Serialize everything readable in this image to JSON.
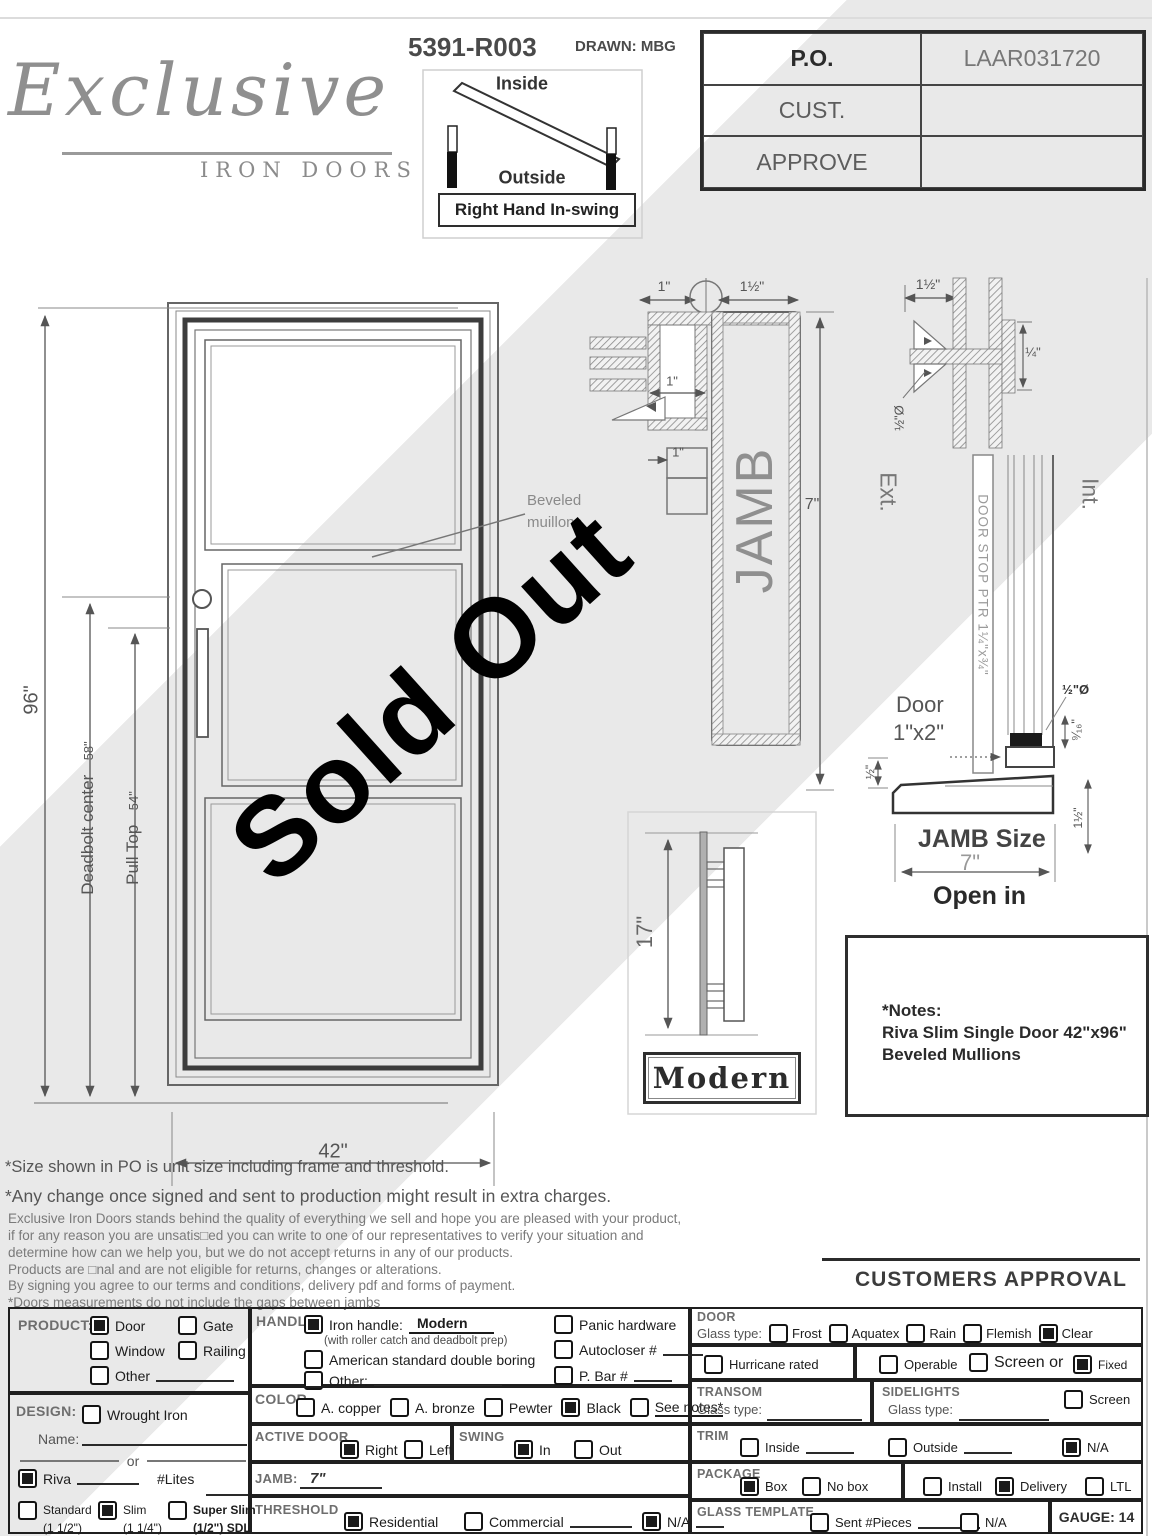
{
  "header": {
    "logo_script": "Exclusive",
    "logo_subtitle": "IRON DOORS",
    "drawing_number": "5391-R003",
    "drawn_by": "DRAWN: MBG"
  },
  "swing_diagram": {
    "inside_label": "Inside",
    "outside_label": "Outside",
    "caption": "Right Hand In-swing"
  },
  "po_table": {
    "rows": [
      {
        "label": "P.O.",
        "value": "LAAR031720"
      },
      {
        "label": "CUST.",
        "value": ""
      },
      {
        "label": "APPROVE",
        "value": ""
      }
    ]
  },
  "elevation": {
    "height_dim": "96\"",
    "deadbolt_label": "Deadbolt center",
    "deadbolt_dim": "58\"",
    "pull_label": "Pull Top",
    "pull_dim": "54\"",
    "width_dim": "42\"",
    "mullion_note_line1": "Beveled",
    "mullion_note_line2": "muillons"
  },
  "jamb_detail": {
    "dim_top_left": "1\"",
    "dim_top_right": "1½\"",
    "dim_mid": "1\"",
    "dim_lower": "1\"",
    "jamb_label": "JAMB",
    "height_dim": "7\""
  },
  "section_detail": {
    "dim_top": "1½\"",
    "dim_quarter": "¼\"",
    "dim_half_dia": "½\"Ø",
    "ext_label": "Ext.",
    "int_label": "Int.",
    "door_stop_label": "DOOR STOP PTR 1¼\"x¾\"",
    "door_label_line1": "Door",
    "door_label_line2": "1\"x2\"",
    "dim_half_dia_2": "½\"Ø",
    "dim_nine_sixteenths": "⁹⁄₁₆\"",
    "dim_half": "½\"",
    "dim_one_and_half": "1½\"",
    "jamb_size_label": "JAMB Size",
    "jamb_size_value": "7\"",
    "open_label": "Open in"
  },
  "handle_detail": {
    "height_dim": "17\"",
    "style_label": "Modern"
  },
  "notes": {
    "title": "*Notes:",
    "line1": "Riva Slim Single Door 42\"x96\"",
    "line2": "Beveled Mullions"
  },
  "watermark": {
    "text": "Sold Out"
  },
  "disclaimers": {
    "line1": "*Size shown in PO is unit size including frame and threshold.",
    "line2": "*Any change once signed and sent to production might result in extra charges.",
    "line3": "Exclusive Iron Doors stands behind the quality of everything we sell and hope you are pleased with your product,",
    "line4": "if for any reason you are unsatis□ed you can write to one of our representatives to verify your situation and",
    "line5": "determine how can we help you, but we do not accept returns in any of our products.",
    "line6": "Products are □nal and are not eligible for returns, changes or alterations.",
    "line7": "By signing you agree to our terms and conditions, delivery pdf and forms of payment.",
    "line8": "*Doors measurements do not include the gaps between jambs"
  },
  "approval": {
    "title": "CUSTOMERS APPROVAL"
  },
  "form": {
    "product": {
      "label": "PRODUCT:",
      "door": {
        "label": "Door",
        "checked": true
      },
      "gate": {
        "label": "Gate",
        "checked": false
      },
      "window": {
        "label": "Window",
        "checked": false
      },
      "railing": {
        "label": "Railing",
        "checked": false
      },
      "other": {
        "label": "Other",
        "checked": false
      }
    },
    "design": {
      "label": "DESIGN:",
      "wrought_iron": {
        "label": "Wrought Iron",
        "checked": false
      },
      "name_label": "Name:",
      "or_label": "or",
      "riva": {
        "label": "Riva",
        "checked": true
      },
      "lites_label": "#Lites",
      "standard": {
        "label": "Standard",
        "sub": "(1 1/2\")",
        "checked": false
      },
      "slim": {
        "label": "Slim",
        "sub": "(1 1/4\")",
        "checked": true
      },
      "super_slim": {
        "label": "Super Slim",
        "sub": "(1/2\") SDL",
        "checked": false
      }
    },
    "handle": {
      "label": "HANDLE",
      "iron_handle": {
        "label": "Iron handle:",
        "value": "Modern",
        "note": "(with roller catch and deadbolt prep)",
        "checked": true
      },
      "american": {
        "label": "American standard double boring",
        "checked": false
      },
      "other": {
        "label": "Other:",
        "checked": false
      },
      "panic": {
        "label": "Panic hardware",
        "checked": false
      },
      "autocloser": {
        "label": "Autocloser #",
        "checked": false
      },
      "p_bar": {
        "label": "P. Bar #",
        "checked": false
      }
    },
    "color": {
      "label": "COLOR",
      "copper": {
        "label": "A. copper",
        "checked": false
      },
      "bronze": {
        "label": "A. bronze",
        "checked": false
      },
      "pewter": {
        "label": "Pewter",
        "checked": false
      },
      "black": {
        "label": "Black",
        "checked": true
      },
      "see_notes": {
        "label": "See notes*",
        "checked": false
      }
    },
    "active_door": {
      "label": "ACTIVE DOOR",
      "right": {
        "label": "Right",
        "checked": true
      },
      "left": {
        "label": "Left",
        "checked": false
      }
    },
    "swing": {
      "label": "SWING",
      "in": {
        "label": "In",
        "checked": true
      },
      "out": {
        "label": "Out",
        "checked": false
      }
    },
    "jamb": {
      "label": "JAMB:",
      "value": "7\""
    },
    "threshold": {
      "label": "THRESHOLD",
      "residential": {
        "label": "Residential",
        "checked": true
      },
      "commercial": {
        "label": "Commercial",
        "checked": false
      },
      "na": {
        "label": "N/A",
        "checked": true
      }
    },
    "door_glass": {
      "label": "DOOR",
      "glass_type_label": "Glass type:",
      "frost": {
        "label": "Frost",
        "checked": false
      },
      "aquatex": {
        "label": "Aquatex",
        "checked": false
      },
      "rain": {
        "label": "Rain",
        "checked": false
      },
      "flemish": {
        "label": "Flemish",
        "checked": false
      },
      "clear": {
        "label": "Clear",
        "checked": true
      }
    },
    "hurricane": {
      "label": "Hurricane rated",
      "checked": false
    },
    "operable": {
      "label": "Operable",
      "checked": false
    },
    "screen_or": {
      "label": "Screen or",
      "checked": false
    },
    "fixed": {
      "label": "Fixed",
      "checked": true
    },
    "transom": {
      "label": "TRANSOM",
      "glass_type_label": "Glass type:"
    },
    "sidelights": {
      "label": "SIDELIGHTS",
      "glass_type_label": "Glass type:",
      "screen": {
        "label": "Screen",
        "checked": false
      }
    },
    "trim": {
      "label": "TRIM",
      "inside": {
        "label": "Inside",
        "checked": false
      },
      "outside": {
        "label": "Outside",
        "checked": false
      },
      "na": {
        "label": "N/A",
        "checked": true
      }
    },
    "package": {
      "label": "PACKAGE",
      "box": {
        "label": "Box",
        "checked": true
      },
      "no_box": {
        "label": "No box",
        "checked": false
      },
      "install": {
        "label": "Install",
        "checked": false
      },
      "delivery": {
        "label": "Delivery",
        "checked": true
      },
      "ltl": {
        "label": "LTL",
        "checked": false
      }
    },
    "glass_template": {
      "label": "GLASS TEMPLATE",
      "sent": {
        "label": "Sent #Pieces",
        "checked": false
      },
      "na": {
        "label": "N/A",
        "checked": false
      }
    },
    "gauge": {
      "label": "GAUGE: 14"
    }
  }
}
